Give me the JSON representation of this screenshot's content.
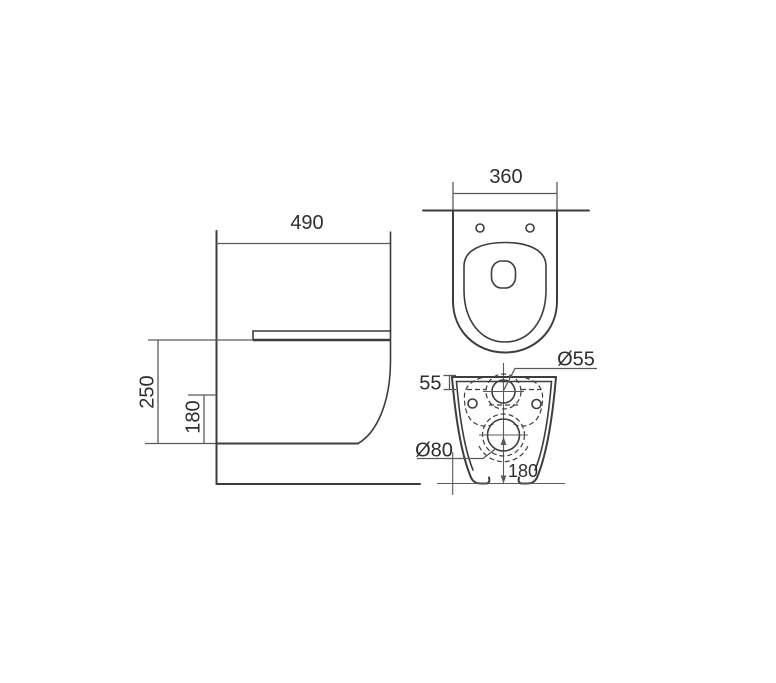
{
  "labels": {
    "side_depth": "490",
    "side_height": "250",
    "side_outlet_height": "180",
    "top_width": "360",
    "rear_inlet_offset": "55",
    "rear_inlet_diameter": "Ø55",
    "rear_outlet_diameter": "Ø80",
    "rear_outlet_height": "180"
  },
  "colors": {
    "background": "#ffffff",
    "outline": "#3d3d3d",
    "dimension": "#5a5a5a",
    "text": "#2e2e2e"
  }
}
